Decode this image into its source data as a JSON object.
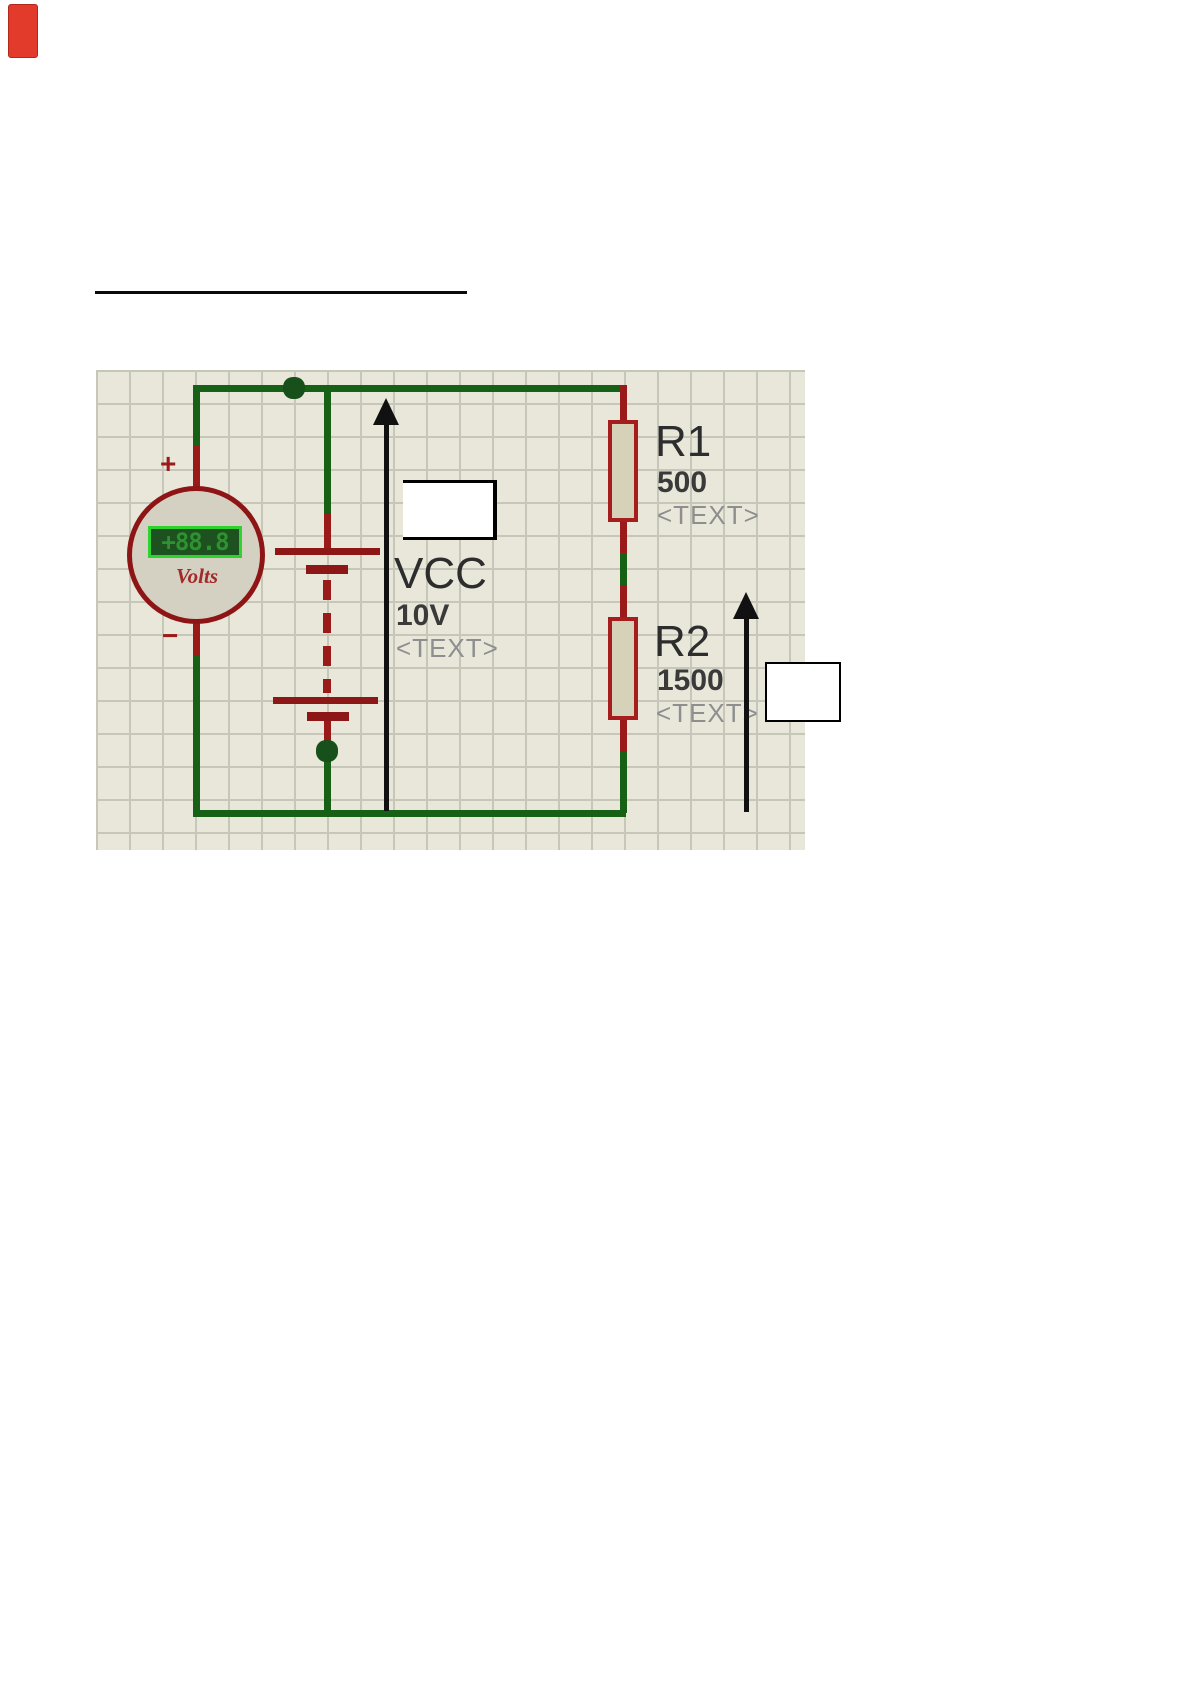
{
  "circuit": {
    "power_source": {
      "ref": "VCC",
      "value": "10V",
      "placeholder": "<TEXT>"
    },
    "resistor_r1": {
      "ref": "R1",
      "value": "500",
      "placeholder": "<TEXT>"
    },
    "resistor_r2": {
      "ref": "R2",
      "value": "1500",
      "placeholder": "<TEXT>"
    },
    "voltmeter": {
      "reading": "+88.8",
      "unit": "Volts",
      "positive_terminal": "+",
      "negative_terminal": "−"
    }
  },
  "colors": {
    "wire_green": "#166116",
    "component_red": "#9a1a1a",
    "resistor_fill": "#d6d2ba",
    "lcd_frame": "#2fd32f",
    "lcd_background": "#1d5220",
    "lcd_text": "#2e9230",
    "grid_background": "#e8e7da",
    "grid_line": "#c7c7b9",
    "label_dark": "#2d2d2d",
    "label_gray": "#8e8e8e",
    "marker_red": "#e23a2b",
    "arrow_black": "#111111"
  }
}
